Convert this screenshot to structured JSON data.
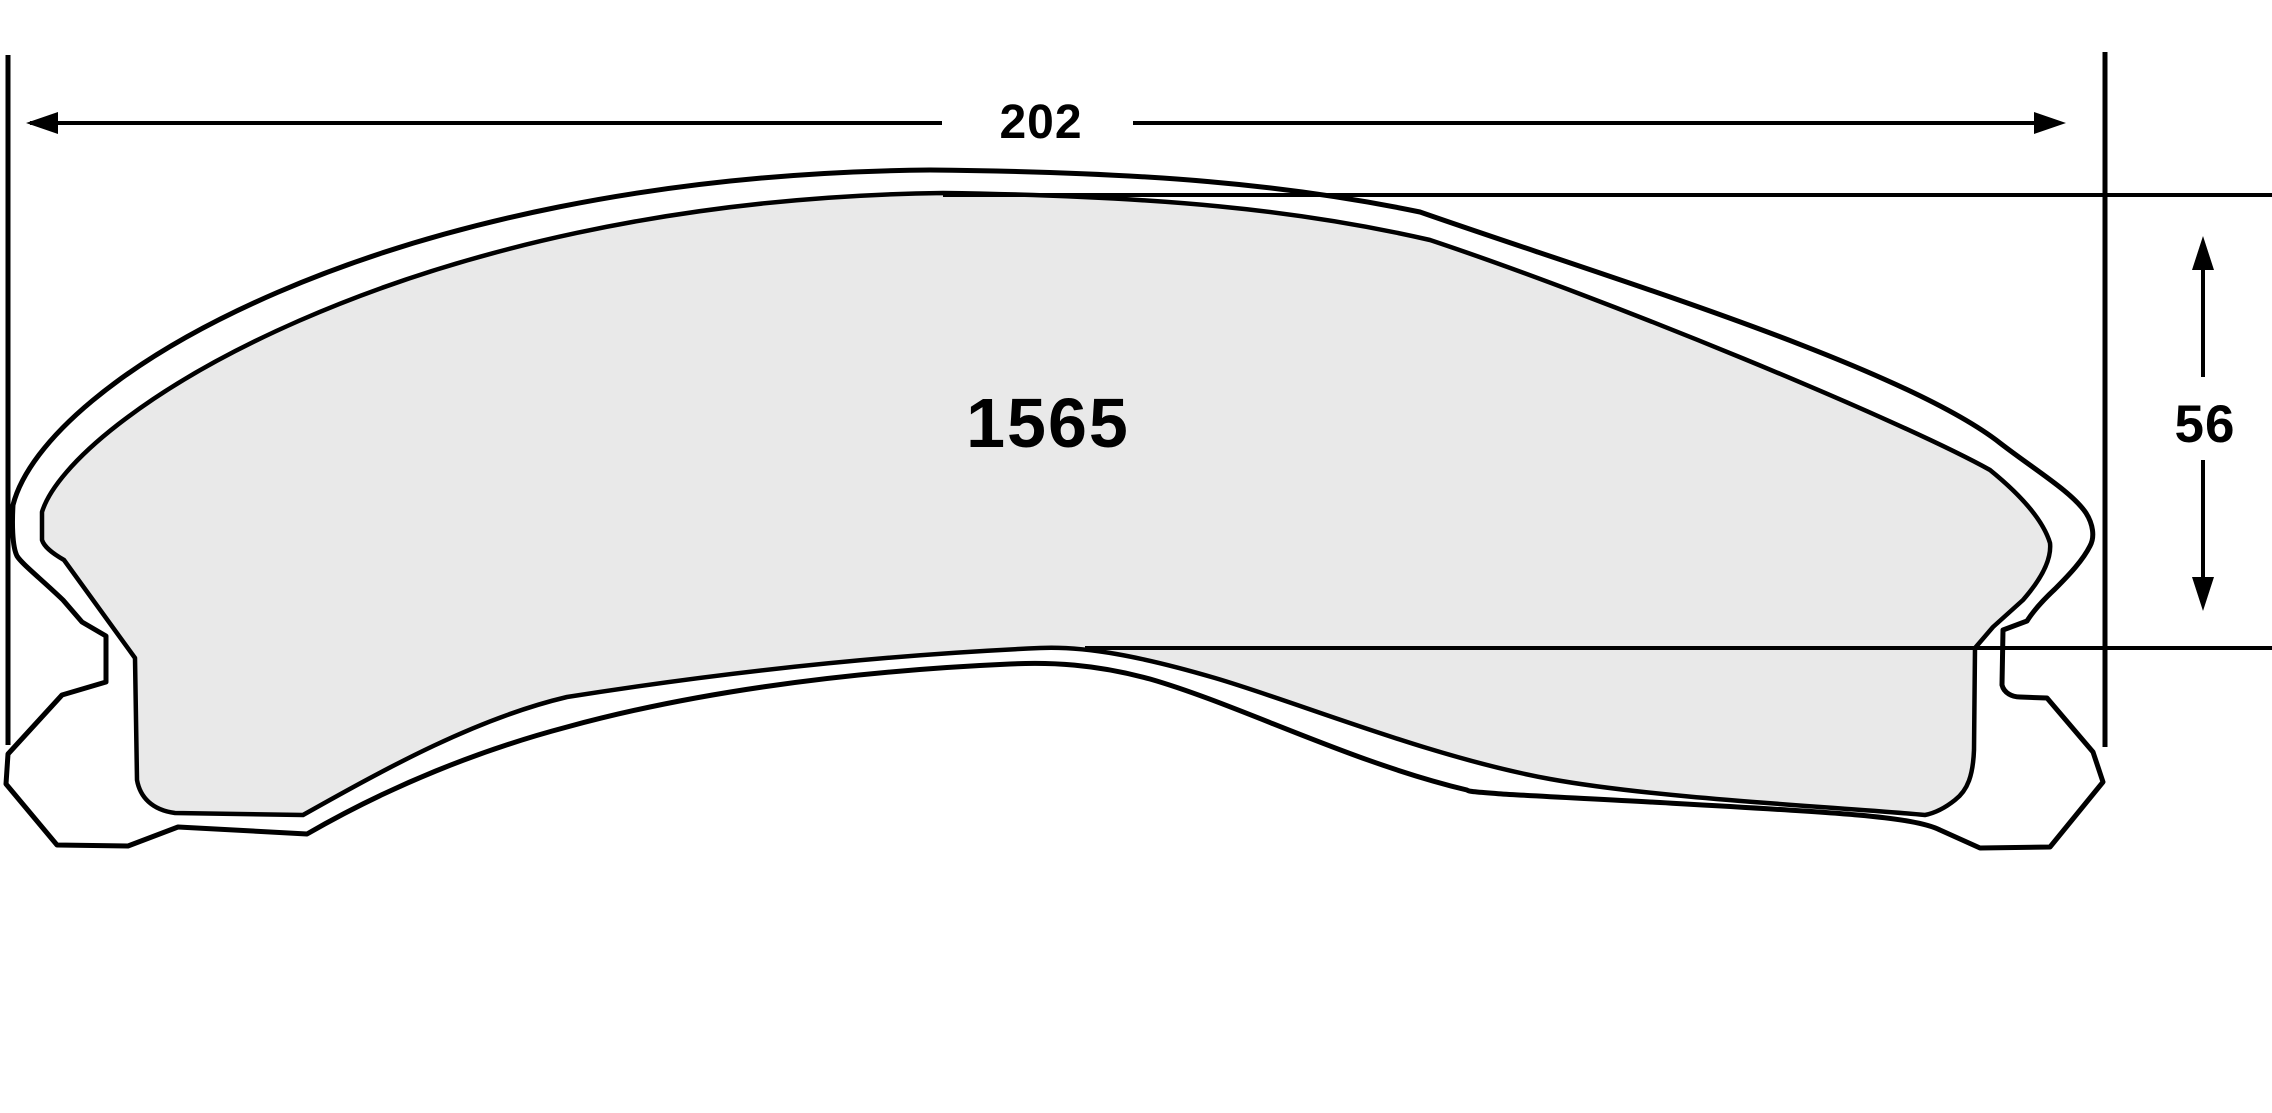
{
  "part": {
    "number": "1565"
  },
  "dimensions": {
    "width_label": "202",
    "height_label": "56"
  },
  "colors": {
    "line": "#000000",
    "background": "#ffffff",
    "friction_fill": "#e9e9e9"
  }
}
